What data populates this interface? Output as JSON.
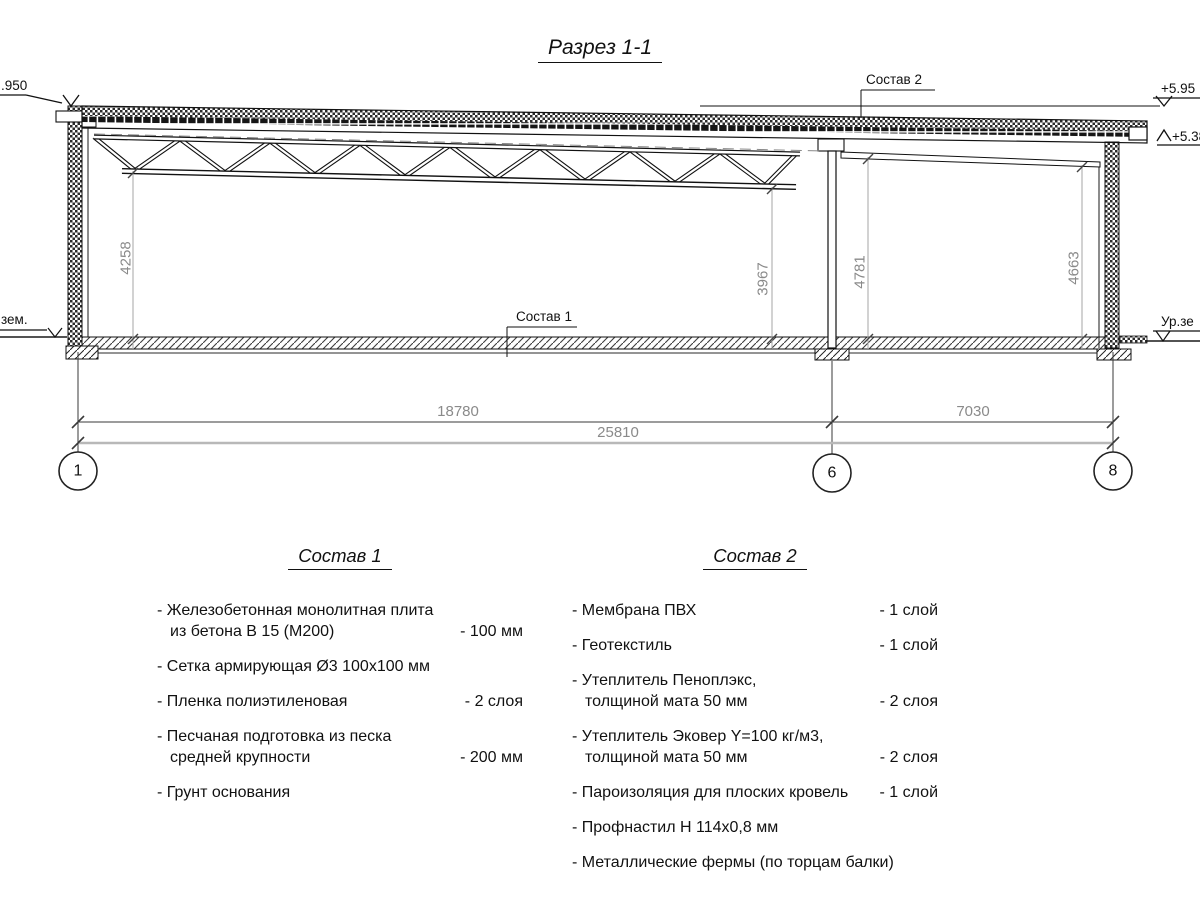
{
  "title": "Разрез 1-1",
  "drawing": {
    "labels": {
      "sostav1": "Состав 1",
      "sostav2": "Состав 2",
      "elev_left": ".950",
      "elev_right_top": "+5.95",
      "elev_right_low": "+5.38",
      "ground_left": "зем.",
      "ground_right": "Ур.зе"
    },
    "dims": {
      "h_left": "4258",
      "h_mid": "3967",
      "h_right1": "4781",
      "h_right2": "4663",
      "span1": "18780",
      "span2": "7030",
      "total": "25810"
    },
    "axes": {
      "a1": "1",
      "a6": "6",
      "a8": "8"
    },
    "colors": {
      "line": "#1a1a1a",
      "dim": "#8a8a8a",
      "hatch": "#2b2b2b"
    }
  },
  "spec1": {
    "heading": "Состав 1",
    "items": [
      {
        "line1": "- Железобетонная  монолитная плита",
        "line2": "из бетона В 15 (М200)",
        "value": "- 100 мм"
      },
      {
        "line1": "- Сетка армирующая Ø3 100x100 мм"
      },
      {
        "line1": "- Пленка полиэтиленовая",
        "value": "- 2 слоя"
      },
      {
        "line1": "- Песчаная подготовка из песка",
        "line2": "средней крупности",
        "value": "- 200 мм"
      },
      {
        "line1": "- Грунт основания"
      }
    ]
  },
  "spec2": {
    "heading": "Состав 2",
    "items": [
      {
        "line1": "- Мембрана ПВХ",
        "value": "- 1 слой"
      },
      {
        "line1": "- Геотекстиль",
        "value": "- 1 слой"
      },
      {
        "line1": "- Утеплитель Пеноплэкс,",
        "line2": "толщиной мата 50 мм",
        "value": "- 2 слоя"
      },
      {
        "line1": "- Утеплитель Эковер Y=100 кг/м3,",
        "line2": "толщиной мата 50 мм",
        "value": "- 2 слоя"
      },
      {
        "line1": "- Пароизоляция для плоских кровель",
        "value": "- 1 слой"
      },
      {
        "line1": "- Профнастил Н 114x0,8 мм"
      },
      {
        "line1": "- Металлические фермы (по торцам балки)"
      }
    ]
  }
}
